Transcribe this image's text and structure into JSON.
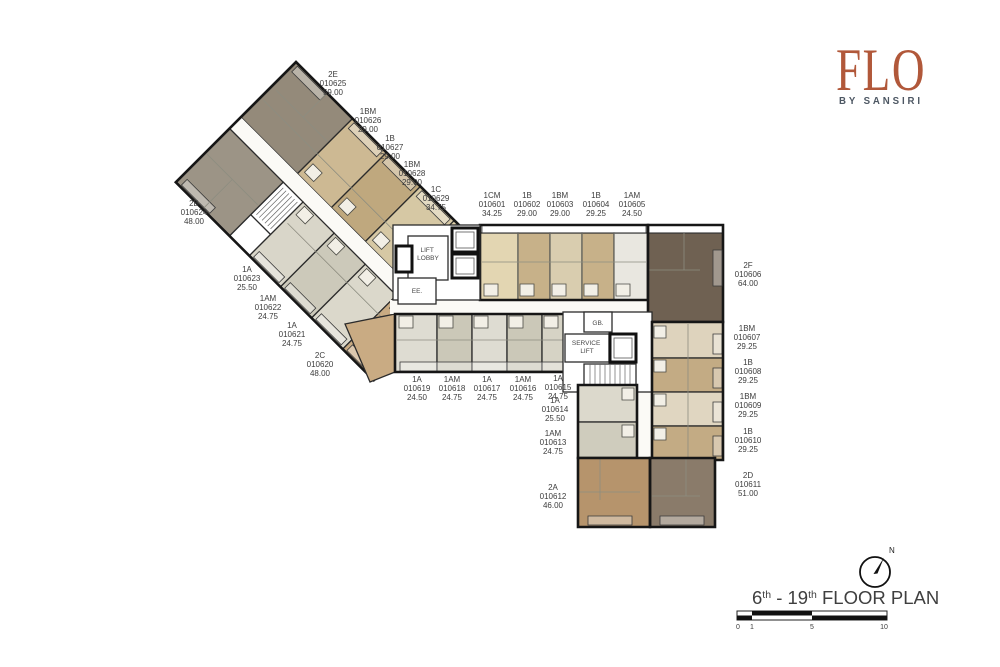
{
  "logo": {
    "name": "FLO",
    "tagline": "BY SANSIRI",
    "color": "#b1583a",
    "tagline_color": "#4d5763"
  },
  "plan": {
    "title": {
      "floor_start": "6",
      "ordinal": "th",
      "floor_end": " - 19",
      "suffix": " FLOOR PLAN"
    },
    "north_label": "N",
    "scale_ticks": [
      "0",
      "1",
      "5",
      "10"
    ]
  },
  "core": {
    "lift_lobby_line1": "LIFT",
    "lift_lobby_line2": "LOBBY",
    "ee": "EE.",
    "gb": "GB.",
    "service_line1": "SERVICE",
    "service_line2": "LIFT"
  },
  "units": [
    {
      "type": "1CM",
      "code": "010601",
      "area": "34.25",
      "color": "#e3d6b2"
    },
    {
      "type": "1B",
      "code": "010602",
      "area": "29.00",
      "color": "#c7b189"
    },
    {
      "type": "1BM",
      "code": "010603",
      "area": "29.00",
      "color": "#d9cdaf"
    },
    {
      "type": "1B",
      "code": "010604",
      "area": "29.25",
      "color": "#c7b189"
    },
    {
      "type": "1AM",
      "code": "010605",
      "area": "24.50",
      "color": "#e9e7e0"
    },
    {
      "type": "2F",
      "code": "010606",
      "area": "64.00",
      "color": "#6f6152"
    },
    {
      "type": "1BM",
      "code": "010607",
      "area": "29.25",
      "color": "#ded3bd"
    },
    {
      "type": "1B",
      "code": "010608",
      "area": "29.25",
      "color": "#c3ab84"
    },
    {
      "type": "1BM",
      "code": "010609",
      "area": "29.25",
      "color": "#e0d6c1"
    },
    {
      "type": "1B",
      "code": "010610",
      "area": "29.25",
      "color": "#c3ab84"
    },
    {
      "type": "2D",
      "code": "010611",
      "area": "51.00",
      "color": "#8a7b6a"
    },
    {
      "type": "2A",
      "code": "010612",
      "area": "46.00",
      "color": "#b6946c"
    },
    {
      "type": "1AM",
      "code": "010613",
      "area": "24.75",
      "color": "#cfccbd"
    },
    {
      "type": "1A",
      "code": "010614",
      "area": "25.50",
      "color": "#dcd9cc"
    },
    {
      "type": "1A",
      "code": "010615",
      "area": "24.75",
      "color": "#d6d3c5"
    },
    {
      "type": "1AM",
      "code": "010616",
      "area": "24.75",
      "color": "#cbc8b8"
    },
    {
      "type": "1A",
      "code": "010617",
      "area": "24.75",
      "color": "#dedcd2"
    },
    {
      "type": "1AM",
      "code": "010618",
      "area": "24.75",
      "color": "#cbc8b8"
    },
    {
      "type": "1A",
      "code": "010619",
      "area": "24.50",
      "color": "#dedcd2"
    },
    {
      "type": "2C",
      "code": "010620",
      "area": "48.00",
      "color": "#c9ab83"
    },
    {
      "type": "1A",
      "code": "010621",
      "area": "24.75",
      "color": "#dbd8cb"
    },
    {
      "type": "1AM",
      "code": "010622",
      "area": "24.75",
      "color": "#ccc9ba"
    },
    {
      "type": "1A",
      "code": "010623",
      "area": "25.50",
      "color": "#d9d6c9"
    },
    {
      "type": "2B",
      "code": "010624",
      "area": "48.00",
      "color": "#9c9486"
    },
    {
      "type": "2E",
      "code": "010625",
      "area": "59.00",
      "color": "#948a7a"
    },
    {
      "type": "1BM",
      "code": "010626",
      "area": "29.00",
      "color": "#cdb993"
    },
    {
      "type": "1B",
      "code": "010627",
      "area": "29.00",
      "color": "#bfa87e"
    },
    {
      "type": "1BM",
      "code": "010628",
      "area": "29.00",
      "color": "#d6c8a4"
    },
    {
      "type": "1C",
      "code": "010629",
      "area": "34.75",
      "color": "#e0d2ab"
    }
  ]
}
